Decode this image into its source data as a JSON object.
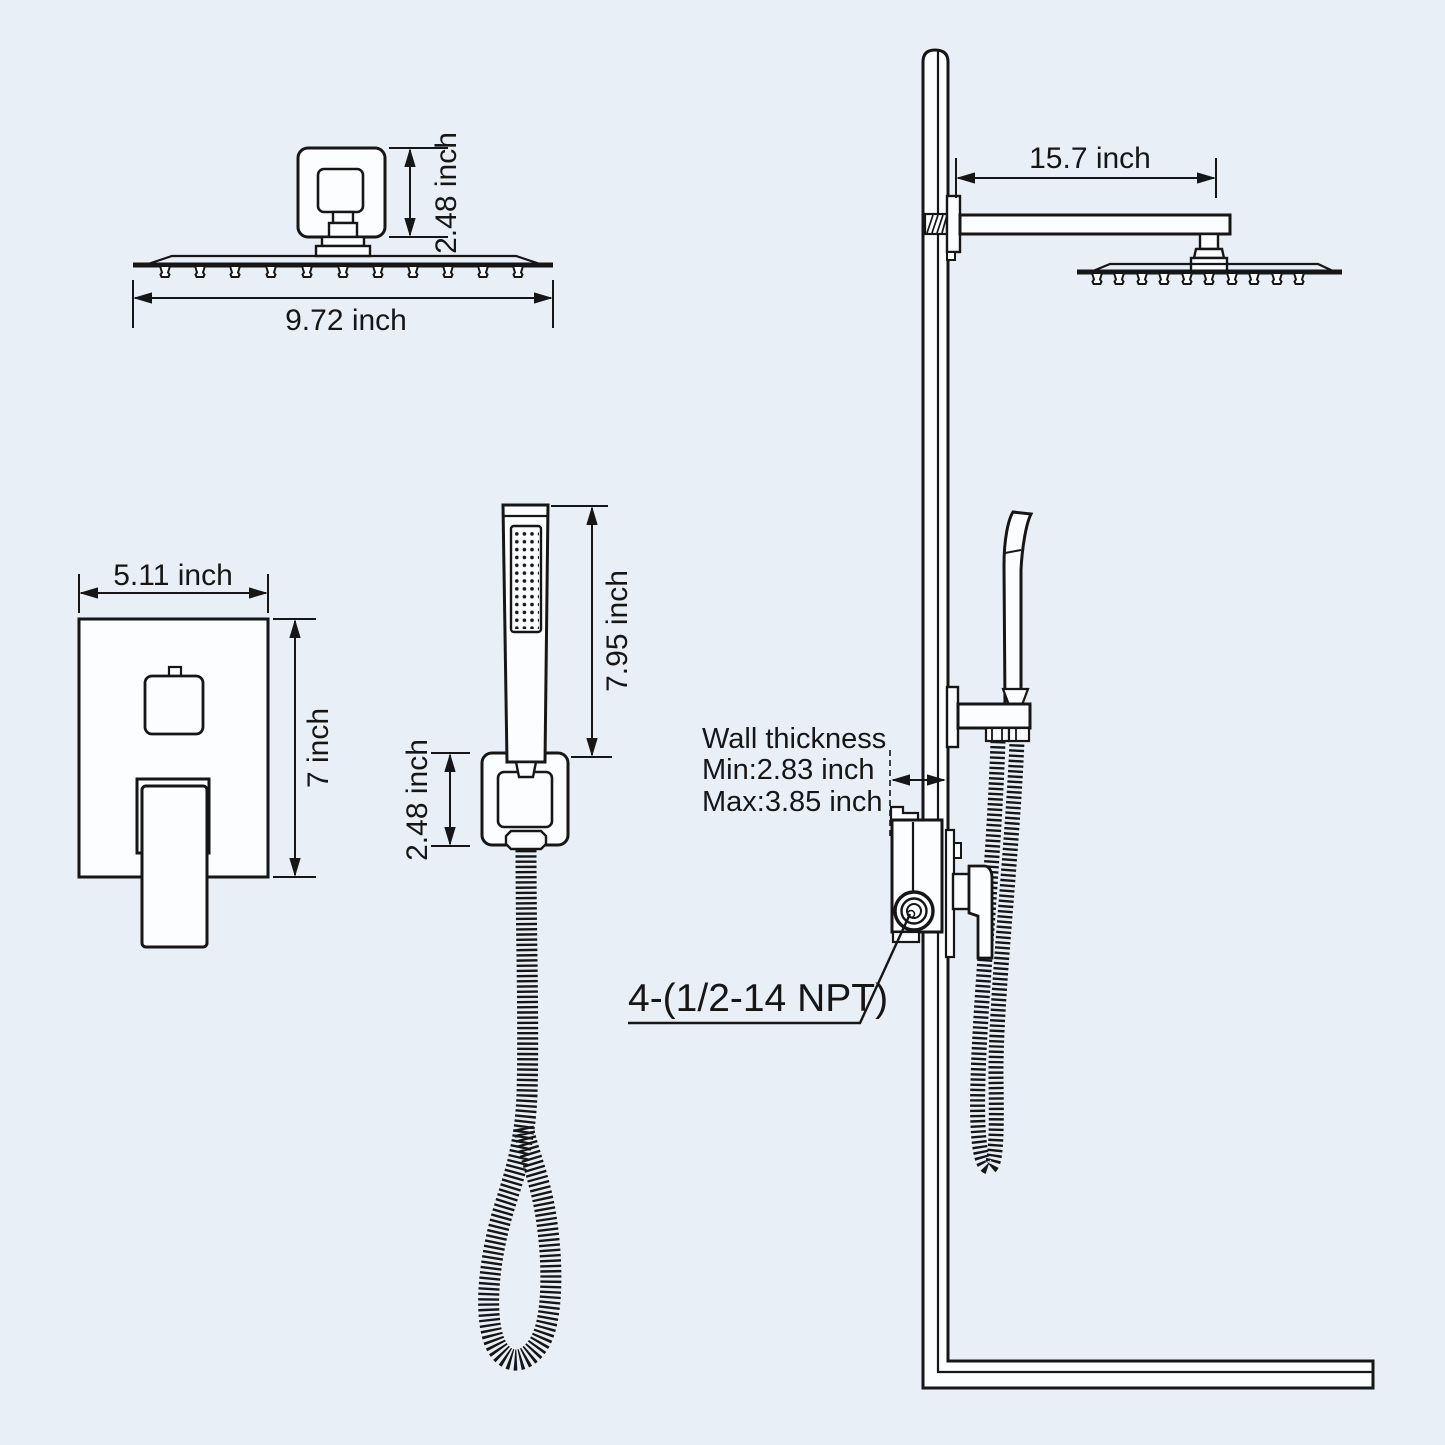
{
  "title": "Shower system installation dimension diagram",
  "colors": {
    "background": "#e9eff7",
    "line": "#161616",
    "fill": "#fbfdff"
  },
  "figures": {
    "head_side": {
      "height_label": "2.48 inch",
      "width_label": "9.72 inch"
    },
    "valve": {
      "width_label": "5.11 inch",
      "height_label": "7 inch"
    },
    "hand_shower": {
      "length_label": "7.95 inch",
      "bracket_label": "2.48 inch"
    },
    "assembly": {
      "arm_label": "15.7 inch",
      "wall_thickness_title": "Wall thickness",
      "wall_thickness_min": "Min:2.83 inch",
      "wall_thickness_max": "Max:3.85 inch",
      "thread_label": "4-(1/2-14 NPT)"
    }
  }
}
